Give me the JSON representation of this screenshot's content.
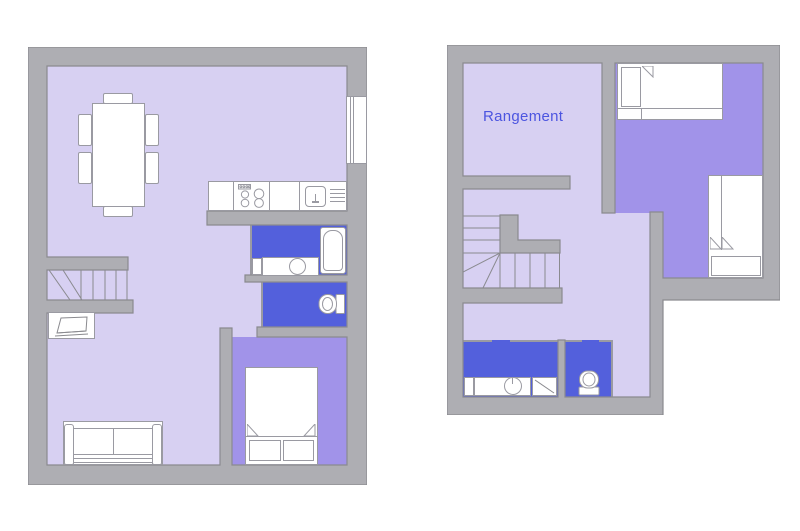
{
  "labels": {
    "storage_room": "Rangement"
  },
  "colors": {
    "page_bg": "#ffffff",
    "wall_fill": "#aeaeb3",
    "wall_edge": "#8a8a8f",
    "floor_light": "#d7d0f2",
    "floor_bedroom": "#a193e9",
    "floor_bath": "#5360dc",
    "fixture_fill": "#ffffff",
    "fixture_edge": "#9a9aa2",
    "label_color": "#4c55e0"
  }
}
